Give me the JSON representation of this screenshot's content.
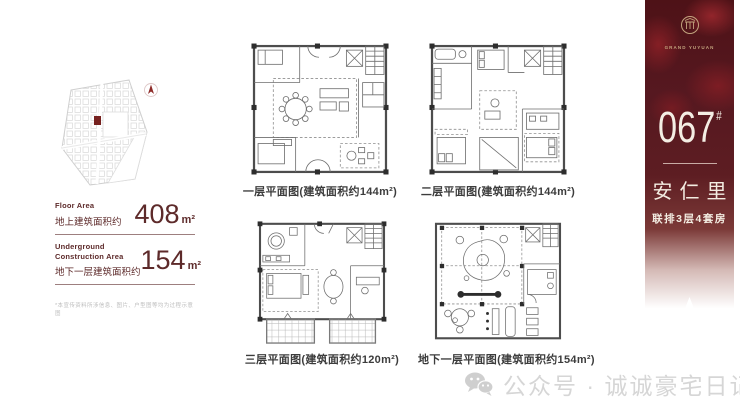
{
  "site_panel": {
    "rows": [
      {
        "label_en": "Floor Area",
        "label_zh": "地上建筑面积约",
        "value": "408",
        "unit": "m²"
      },
      {
        "label_en": "Underground Construction Area",
        "label_zh": "地下一层建筑面积约",
        "value": "154",
        "unit": "m²"
      }
    ],
    "disclaimer": "*本宣传资料所涉信息、图片、户型图等均为过程示意图"
  },
  "floor_plans": [
    {
      "caption": "一层平面图(建筑面积约144m²)"
    },
    {
      "caption": "二层平面图(建筑面积约144m²)"
    },
    {
      "caption": "三层平面图(建筑面积约120m²)"
    },
    {
      "caption": "地下一层平面图(建筑面积约154m²)"
    }
  ],
  "sidebar": {
    "brand_name": "GRAND YUYUAN",
    "unit_number": "067",
    "unit_number_suffix": "#",
    "project_name": "安仁里",
    "project_subtitle": "联排3层4套房",
    "colors": {
      "background": "#5d1d22",
      "text": "#f3ece1",
      "accent": "#c3a47e"
    }
  },
  "watermark": {
    "label": "公众号 · 诚诚豪宅日记"
  }
}
